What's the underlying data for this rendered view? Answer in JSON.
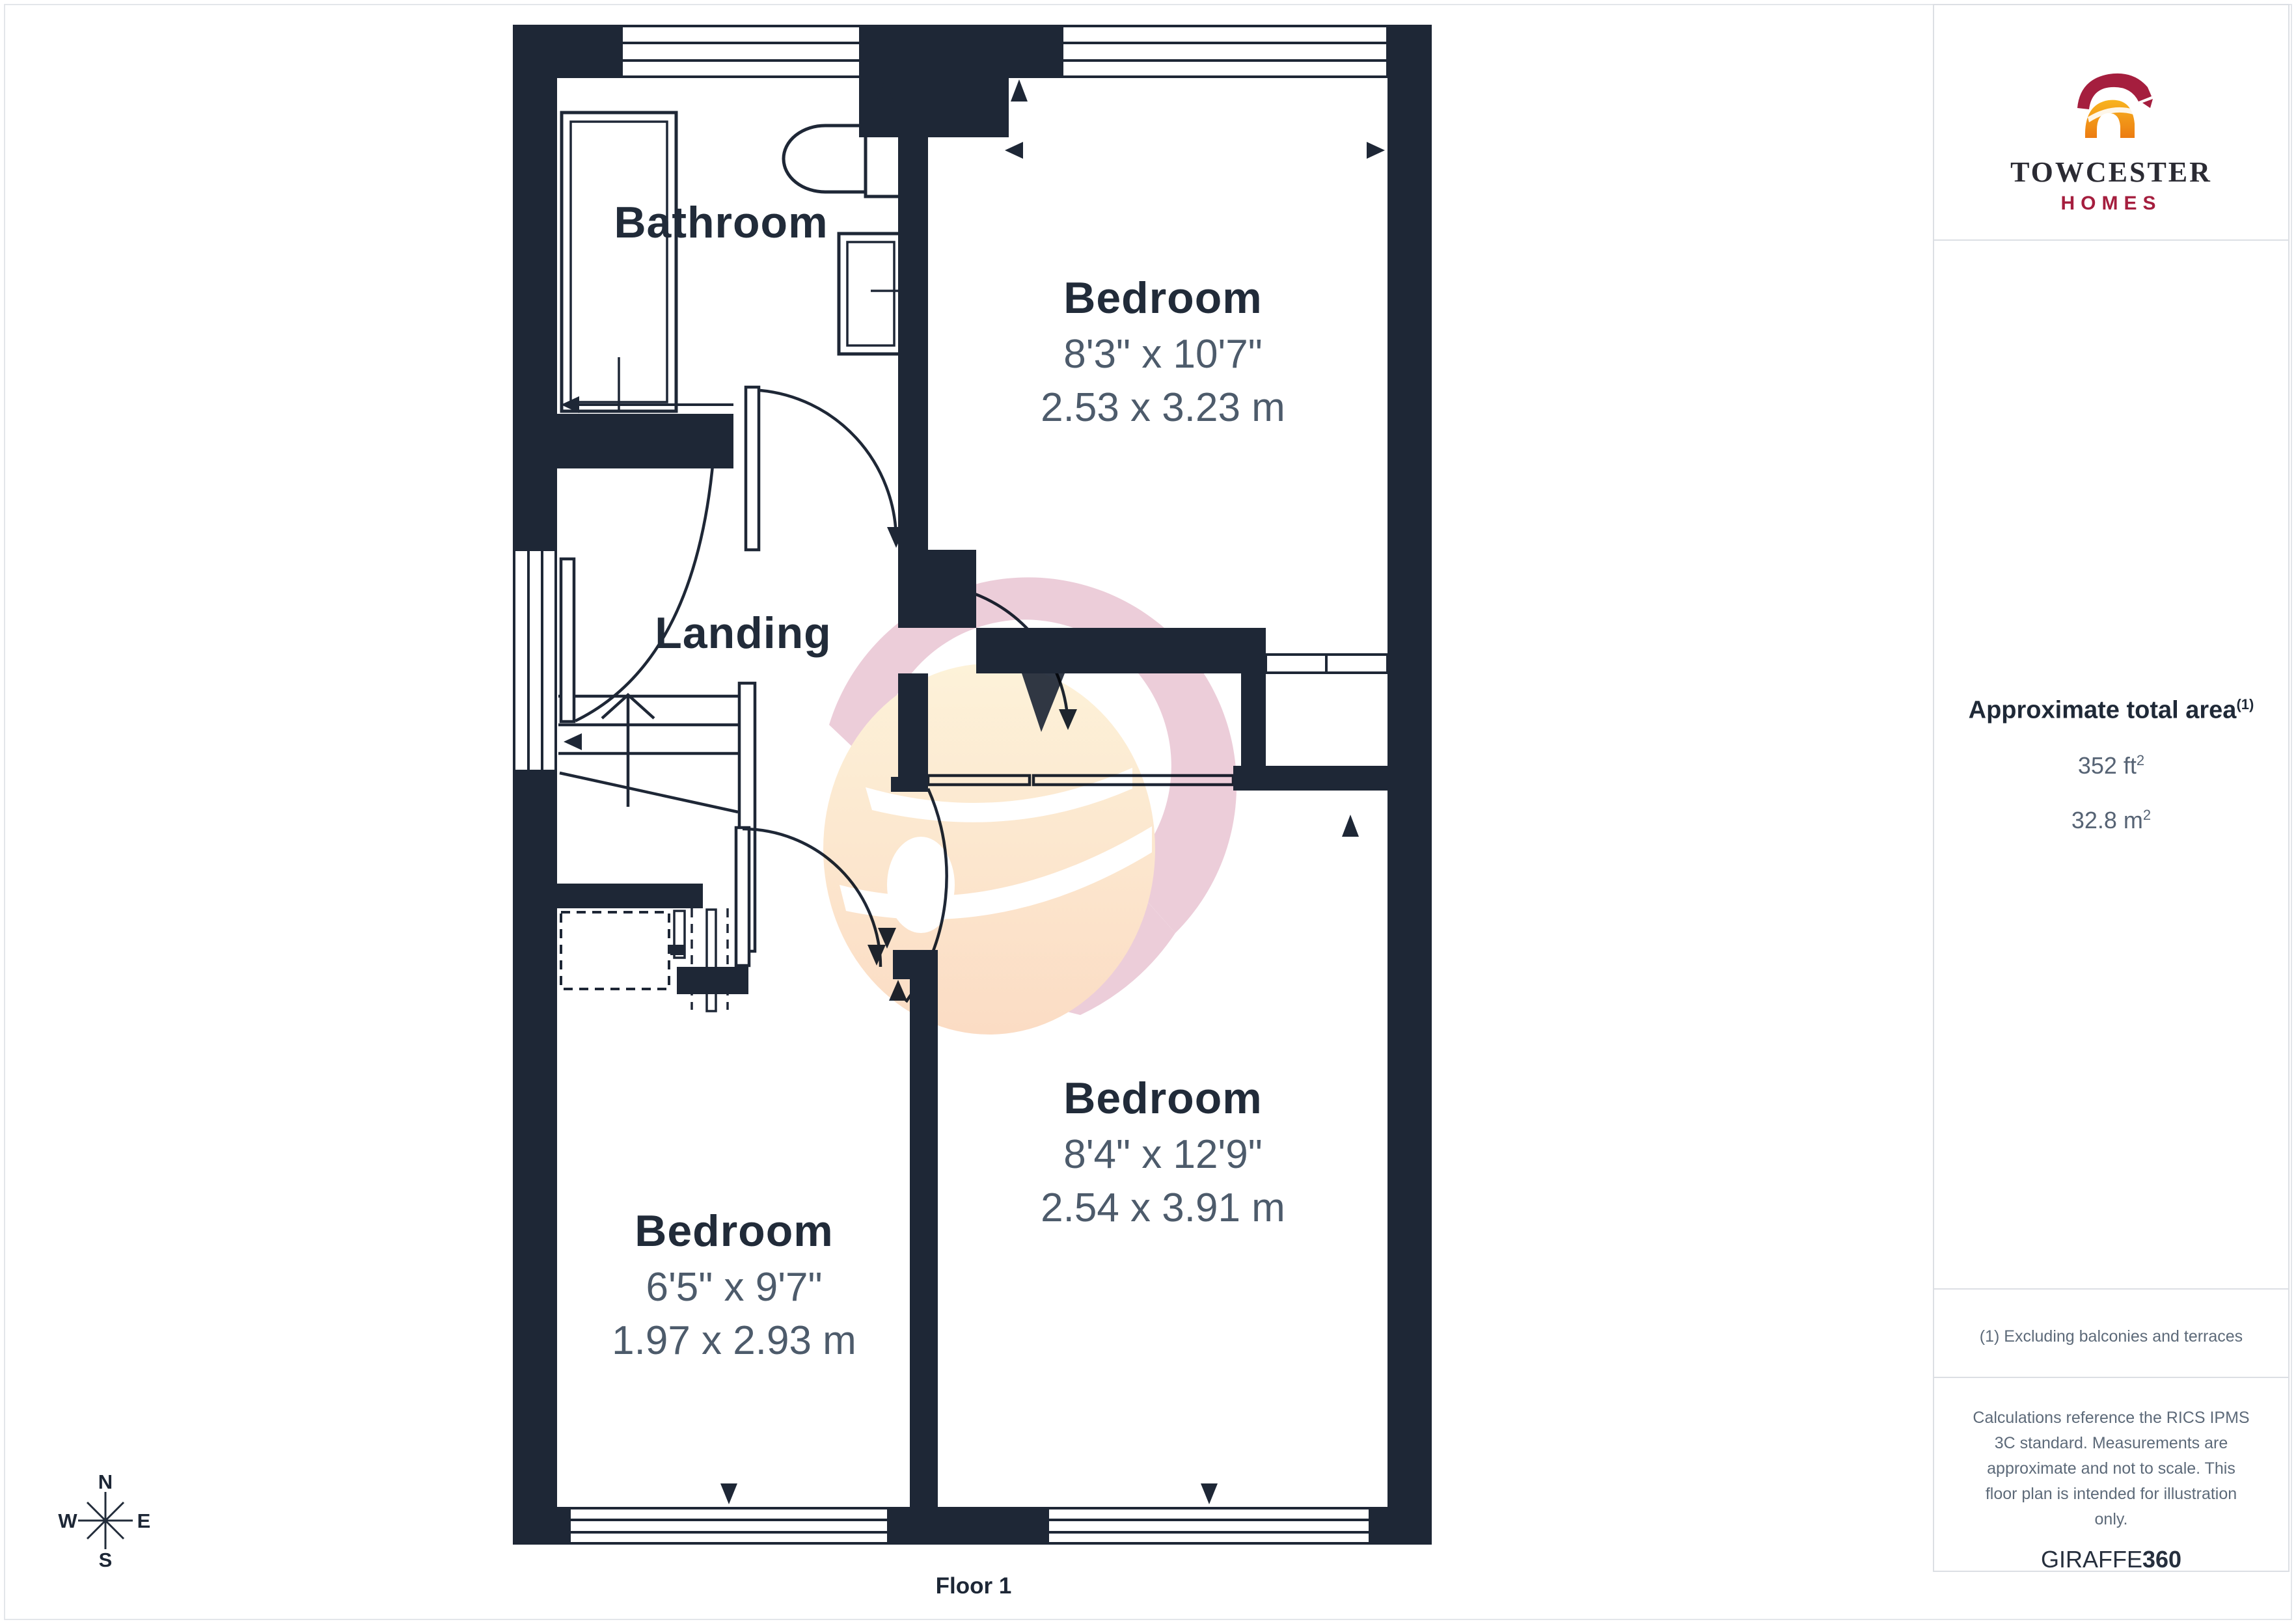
{
  "page": {
    "floor_label": "Floor 1"
  },
  "branding": {
    "logo_title": "TOWCESTER",
    "logo_subtitle": "HOMES"
  },
  "sidebar": {
    "area_title": "Approximate total area",
    "area_footnote_ref": "(1)",
    "area_imperial": "352 ft",
    "area_metric": "32.8 m",
    "sup": "2",
    "footnote": "(1) Excluding balconies and terraces",
    "disclaimer_lines": [
      "Calculations reference the RICS IPMS",
      "3C standard. Measurements are",
      "approximate and not to scale. This",
      "floor plan is intended for illustration",
      "only."
    ],
    "credit_name": "GIRAFFE",
    "credit_number": "360"
  },
  "floorplan": {
    "compass": {
      "n": "N",
      "e": "E",
      "s": "S",
      "w": "W"
    },
    "rooms": [
      {
        "id": "bathroom",
        "name": "Bathroom",
        "imperial": "",
        "metric": ""
      },
      {
        "id": "bedroom-1",
        "name": "Bedroom",
        "imperial": "8'3\" x 10'7\"",
        "metric": "2.53 x 3.23 m"
      },
      {
        "id": "landing",
        "name": "Landing",
        "imperial": "",
        "metric": ""
      },
      {
        "id": "bedroom-2",
        "name": "Bedroom",
        "imperial": "8'4\" x 12'9\"",
        "metric": "2.54 x 3.91 m"
      },
      {
        "id": "bedroom-3",
        "name": "Bedroom",
        "imperial": "6'5\" x 9'7\"",
        "metric": "1.97 x 2.93 m"
      }
    ],
    "colors": {
      "wall": "#1e2736",
      "label": "#212b39",
      "dimension_text": "#4d5b6b",
      "watermark_pink": "#eccdd9",
      "watermark_cream": "#fdeecb",
      "logo_crimson": "#a51e3e",
      "logo_gold": "#f2991d"
    }
  }
}
